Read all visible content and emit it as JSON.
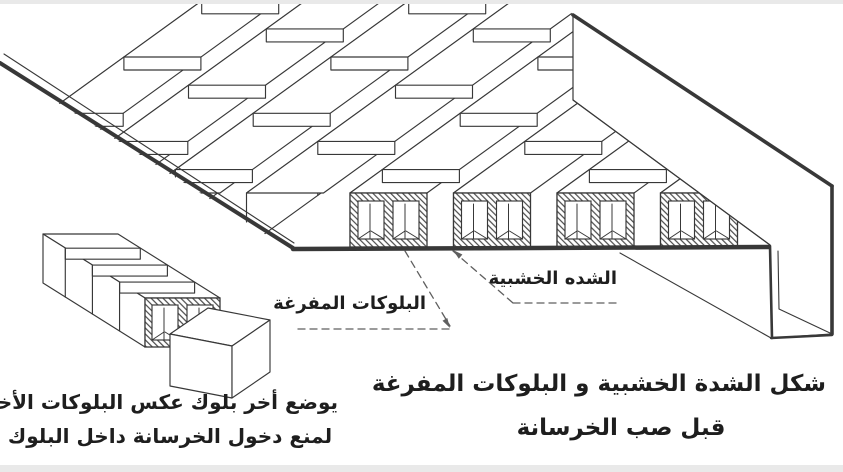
{
  "figure": {
    "type": "isometric-technical-drawing",
    "subject": "wooden formwork with hollow blocks before casting concrete",
    "callouts": {
      "formwork": "الشده الخشبية",
      "hollow_blocks": "البلوكات المفرغة"
    },
    "caption_main": {
      "line1": "شكل الشدة الخشبية و البلوكات المفرغة",
      "line2": "قبل صب الخرسانة"
    },
    "caption_detail": {
      "line1": "يوضع أخر بلوك عكس البلوكات الأخرى",
      "line2": "لمنع دخول الخرسانة داخل البلوك"
    },
    "colors": {
      "ink": "#383838",
      "paper": "#ffffff",
      "page_margin": "#e9e9e9",
      "hatch": "#4a4a4a",
      "leader": "#5f5f5f"
    }
  }
}
